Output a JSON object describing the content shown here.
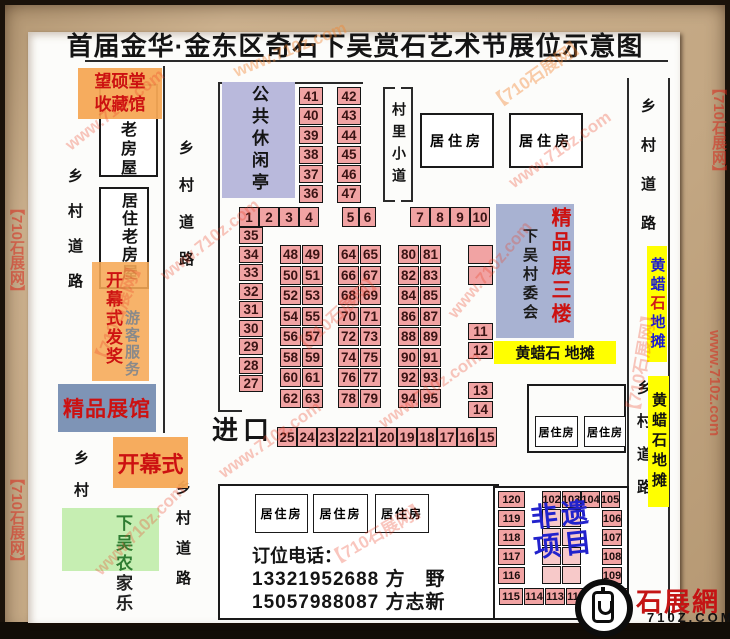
{
  "title": "首届金华·金东区奇石下吴赏石艺术节展位示意图",
  "roads": {
    "country_road": "乡村道路",
    "village_path": "村里小道"
  },
  "labels": {
    "wangshuo_line1": "望硕堂",
    "wangshuo_line2": "收藏馆",
    "old_house": "老房屋",
    "old_residence": "居住老房屋",
    "ceremony_award": "开幕式发奖",
    "visitor_service": "游客服务",
    "boutique_hall": "精品展馆",
    "opening_ceremony": "开幕式",
    "farmhouse_part1": "下吴农",
    "farmhouse_part2": "家乐",
    "leisure_pavilion": "公共休闲亭",
    "residence": "居住房",
    "village_committee": "下吴村委会",
    "boutique_floor3": "精品展三楼",
    "wax_stone_stall_h": "黄蜡石 地摊",
    "wax_stone_v1": "黄蜡",
    "wax_stone_v2": "石",
    "wax_stone_v3": "地摊",
    "wax_stone_stall_v": "黄蜡石地摊",
    "entrance": "进口",
    "heritage_line1": "非遗",
    "heritage_line2": "项目"
  },
  "booths": {
    "top_left_col": [
      "41",
      "40",
      "39",
      "38",
      "37",
      "36"
    ],
    "top_right_col": [
      "42",
      "43",
      "44",
      "45",
      "46",
      "47"
    ],
    "row_1_4": [
      "1",
      "2",
      "3",
      "4"
    ],
    "row_5_6": [
      "5",
      "6"
    ],
    "row_7_10": [
      "7",
      "8",
      "9",
      "10"
    ],
    "left_col": [
      "35",
      "34",
      "33",
      "32",
      "31",
      "30",
      "29",
      "28",
      "27"
    ],
    "grid_a": [
      "48",
      "49",
      "50",
      "51",
      "52",
      "53",
      "54",
      "55",
      "56",
      "57",
      "58",
      "59",
      "60",
      "61",
      "62",
      "63"
    ],
    "grid_b": [
      "64",
      "65",
      "66",
      "67",
      "68",
      "69",
      "70",
      "71",
      "72",
      "73",
      "74",
      "75",
      "76",
      "77",
      "78",
      "79"
    ],
    "grid_c": [
      "80",
      "81",
      "82",
      "83",
      "84",
      "85",
      "86",
      "87",
      "88",
      "89",
      "90",
      "91",
      "92",
      "93",
      "94",
      "95"
    ],
    "small_pair": [
      "",
      ""
    ],
    "col_11_12": [
      "11",
      "12"
    ],
    "col_13_14": [
      "13",
      "14"
    ],
    "bottom_row": [
      "25",
      "24",
      "23",
      "22",
      "21",
      "20",
      "19",
      "18",
      "17",
      "16",
      "15"
    ],
    "br_left": [
      "120",
      "119",
      "118",
      "117",
      "116"
    ],
    "br_top": [
      "102",
      "103",
      "104",
      "105"
    ],
    "br_right": [
      "106",
      "107",
      "108",
      "109"
    ],
    "br_bottom": [
      "115",
      "114",
      "113",
      "112",
      "",
      ""
    ],
    "br_center": [
      "",
      "",
      "",
      "",
      "",
      "",
      "",
      ""
    ]
  },
  "contact": {
    "heading": "订位电话：",
    "phone1": "13321952688 方　野",
    "phone2": "15057988087 方志新"
  },
  "logo": {
    "site_name": "石展網",
    "site_url": "710Z.COM"
  },
  "watermarks": {
    "site": "www.710z.com",
    "brand": "【710石展网】"
  },
  "colors": {
    "booth_pink": "#f1a3a3",
    "orange_label": "#f5a955",
    "lavender": "#b9b9dc",
    "slate_blue": "#a8b2d2",
    "steel_blue": "#7e94b6",
    "light_green": "#c6eeb2",
    "stall_yellow": "#ffff00",
    "red_text": "#cc1111",
    "heritage_blue": "#2222cc"
  }
}
